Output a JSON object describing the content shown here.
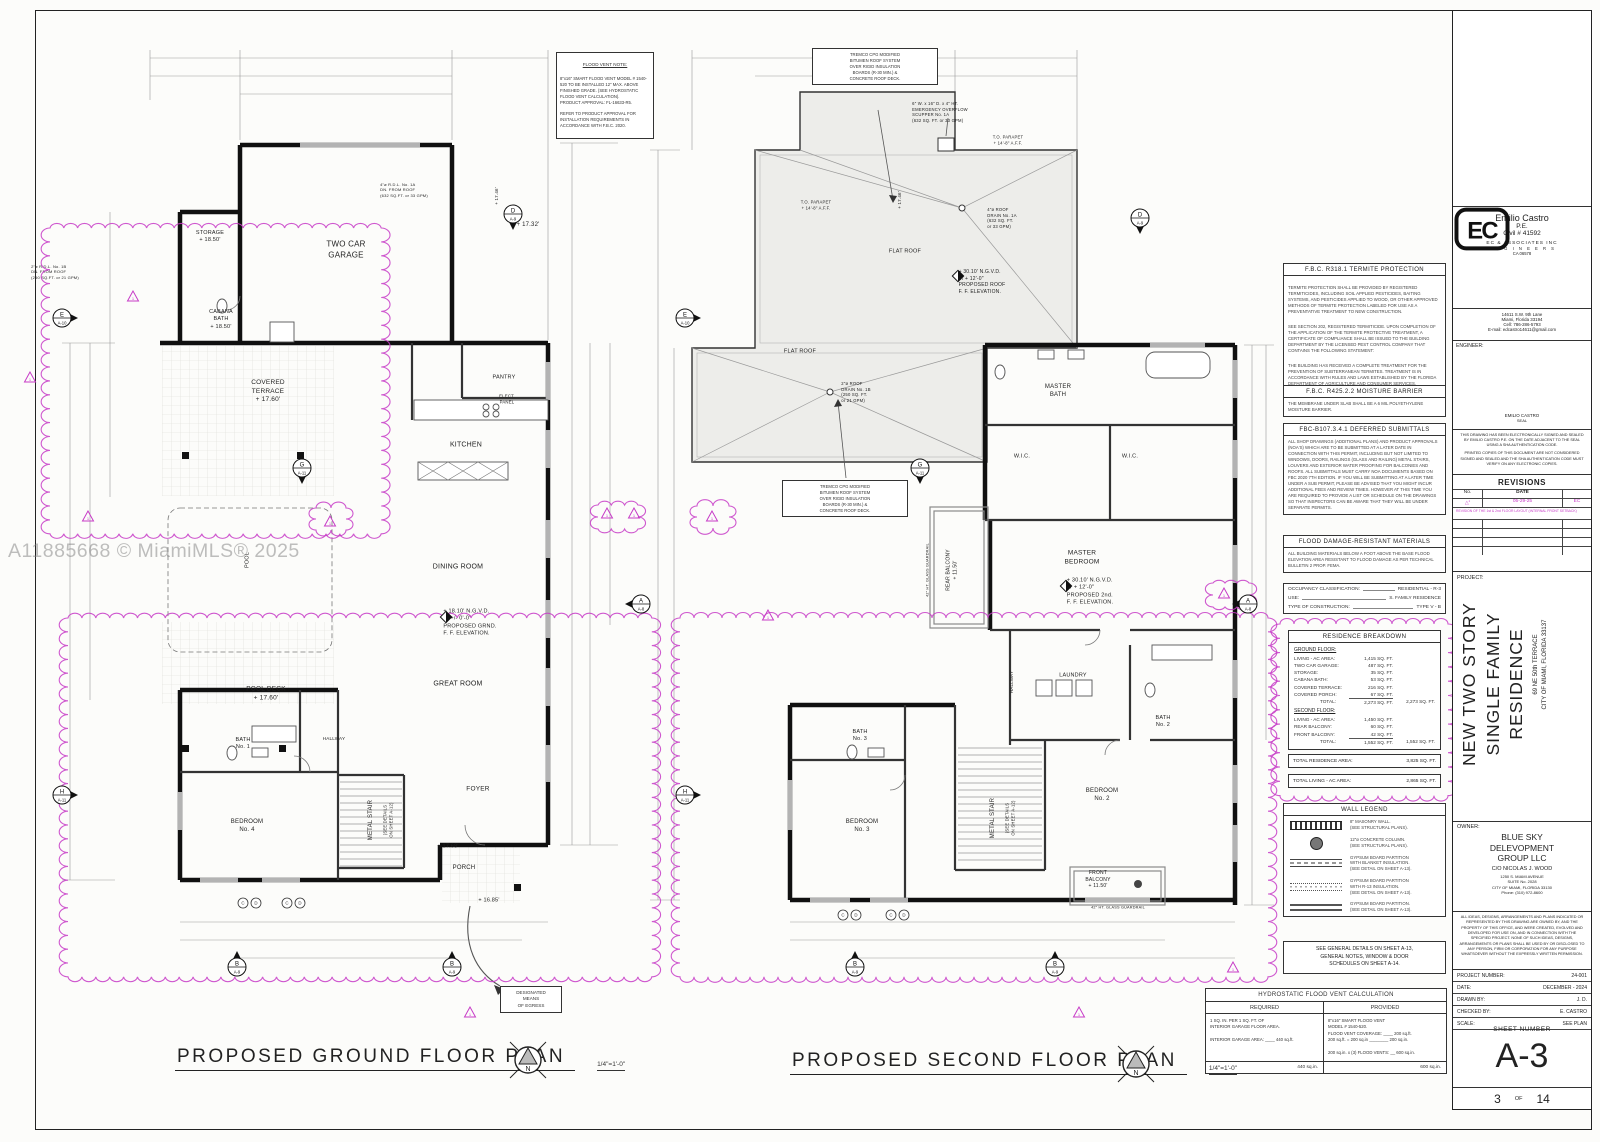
{
  "sheet": {
    "watermark": "A11885668 © MiamiMLS® 2025"
  },
  "plans": {
    "ground": {
      "title": "PROPOSED GROUND FLOOR PLAN",
      "scale": "1/4\"=1'-0\"",
      "flood_vent_note": {
        "title": "FLOOD VENT NOTE:",
        "body": "8\"x16\" SMART FLOOD VENT MODEL # 1540-520 TO BE INSTALLED 12\" MAX. ABOVE FINISHED GRADE. (SEE HYDROSTATIC FLOOD VENT CALCULATION).\nPRODUCT APPROVAL: FL-16633-R5.\n\nREFER TO PRODUCT APPROVAL FOR INSTALLATION REQUIREMENTS IN ACCORDANCE WITH F.B.C. 2020."
      },
      "egress_note": "DESIGNATED\nMEANS\nOF EGRESS"
    },
    "second": {
      "title": "PROPOSED SECOND FLOOR PLAN",
      "scale": "1/4\"=1'-0\"",
      "tremco_note": "TREMCO CPG MODIFIED\nBITUMEN ROOF SYSTEM\nOVER RIGID INSULATION\nBOARDS (R-30 MIN.) &\nCONCRETE ROOF DECK."
    }
  },
  "plan_labels": [
    {
      "n": "storage-label",
      "t": "STORAGE\n+ 18.50'",
      "x": 210,
      "y": 237,
      "fs": 5.5
    },
    {
      "n": "cabana-bath-label",
      "t": "CABANA\nBATH\n+ 18.50'",
      "x": 221,
      "y": 320,
      "fs": 5.5
    },
    {
      "n": "two-car-garage-label",
      "t": "TWO CAR\nGARAGE",
      "x": 346,
      "y": 250,
      "fs": 8
    },
    {
      "n": "elev-1732-label",
      "t": "+ 17.32'",
      "x": 528,
      "y": 226,
      "fs": 6
    },
    {
      "n": "elev-1746-ground-label",
      "t": "+ 17.46'",
      "x": 497,
      "y": 196,
      "fs": 4.5,
      "rot": -90
    },
    {
      "n": "covered-terrace-label",
      "t": "COVERED\nTERRACE\n+ 17.60'",
      "x": 268,
      "y": 392,
      "fs": 6.5
    },
    {
      "n": "pantry-label",
      "t": "PANTRY",
      "x": 504,
      "y": 378,
      "fs": 5.5
    },
    {
      "n": "elect-panel-label",
      "t": "ELECT.\nPANEL",
      "x": 507,
      "y": 399,
      "fs": 4.3
    },
    {
      "n": "kitchen-label",
      "t": "KITCHEN",
      "x": 466,
      "y": 445,
      "fs": 7
    },
    {
      "n": "dining-room-label",
      "t": "DINING ROOM",
      "x": 458,
      "y": 567,
      "fs": 7
    },
    {
      "n": "ground-ff-elevation",
      "t": "+ 18.10' N.G.V.D.\nor +/- 0'-0\"\nPROPOSED GRND.\nF. F. ELEVATION.",
      "x": 470,
      "y": 623,
      "fs": 5.5,
      "al": "left"
    },
    {
      "n": "great-room-label",
      "t": "GREAT ROOM",
      "x": 458,
      "y": 684,
      "fs": 7
    },
    {
      "n": "pool-deck-label",
      "t": "POOL DECK\n+ 17.60'",
      "x": 266,
      "y": 694,
      "fs": 6.5
    },
    {
      "n": "pool-label",
      "t": "POOL",
      "x": 248,
      "y": 560,
      "fs": 5.5,
      "rot": -90
    },
    {
      "n": "bath-1-label",
      "t": "BATH\nNo. 1",
      "x": 243,
      "y": 744,
      "fs": 5.5
    },
    {
      "n": "hallway-ground-label",
      "t": "HALLWAY",
      "x": 334,
      "y": 739,
      "fs": 4.6
    },
    {
      "n": "bedroom-4-label",
      "t": "BEDROOM\nNo. 4",
      "x": 247,
      "y": 827,
      "fs": 6
    },
    {
      "n": "metal-stair-ground-label",
      "t": "METAL STAIR",
      "x": 372,
      "y": 820,
      "fs": 6,
      "rot": -90
    },
    {
      "n": "metal-stair-ground-note",
      "t": "(SEE DETAILS\nON SHEET A-12)",
      "x": 388,
      "y": 820,
      "fs": 4.2,
      "rot": -90
    },
    {
      "n": "foyer-label",
      "t": "FOYER",
      "x": 478,
      "y": 790,
      "fs": 6.5
    },
    {
      "n": "porch-label",
      "t": "PORCH",
      "x": 464,
      "y": 869,
      "fs": 6
    },
    {
      "n": "elev-1768-label",
      "t": "+ 17.68'",
      "x": 448,
      "y": 847,
      "fs": 5.5
    },
    {
      "n": "elev-1685-label",
      "t": "+ 16.85'",
      "x": 489,
      "y": 901,
      "fs": 5.5
    },
    {
      "n": "rdl-1a-note",
      "t": "4\"ø R.D.L. No. 1A\nDN. FROM ROOF\n(632 SQ.FT. or 33 GPM)",
      "x": 404,
      "y": 190,
      "fs": 4,
      "al": "left"
    },
    {
      "n": "rdl-1b-note",
      "t": "2\"ø R.D.L. No. 1B\nDN. FROM ROOF\n(250 SQ.FT. or 21 GPM)",
      "x": 55,
      "y": 272,
      "fs": 4,
      "al": "left"
    },
    {
      "n": "scupper-note",
      "t": "6\" W. x 16\" D. x 4\" HT.\nEMERGENCY OVERFLOW\nSCUPPER No. 1A\n(632 SQ. FT. or 33 GPM)",
      "x": 940,
      "y": 112,
      "fs": 4.2,
      "al": "left"
    },
    {
      "n": "parapet-note-1",
      "t": "T.O. PARAPET\n+ 14'-8\" A.F.F.",
      "x": 1008,
      "y": 140,
      "fs": 4.2
    },
    {
      "n": "parapet-note-2",
      "t": "T.O. PARAPET\n+ 14'-8\" A.F.F.",
      "x": 816,
      "y": 205,
      "fs": 4.2
    },
    {
      "n": "elev-1746-second-label",
      "t": "+ 17.46'",
      "x": 900,
      "y": 200,
      "fs": 4.5,
      "rot": -90
    },
    {
      "n": "roof-drain-1a-note",
      "t": "4\"ø ROOF\nDRAIN No. 1A\n(632 SQ. FT.\nor 33 GPM)",
      "x": 1002,
      "y": 218,
      "fs": 4.2,
      "al": "left"
    },
    {
      "n": "roof-ff-elevation",
      "t": "+ 30.10' N.G.V.D.\nor + 12'-0\"\nPROPOSED ROOF\nF. F. ELEVATION.",
      "x": 982,
      "y": 282,
      "fs": 5,
      "al": "left"
    },
    {
      "n": "flat-roof-label-1",
      "t": "FLAT ROOF",
      "x": 905,
      "y": 252,
      "fs": 5.5
    },
    {
      "n": "flat-roof-label-2",
      "t": "FLAT ROOF",
      "x": 800,
      "y": 352,
      "fs": 5.5
    },
    {
      "n": "roof-drain-1b-note",
      "t": "2\"ø ROOF\nDRAIN No. 1B\n(250 SQ. FT.\nor 21 GPM)",
      "x": 856,
      "y": 392,
      "fs": 4.2,
      "al": "left"
    },
    {
      "n": "master-bath-label",
      "t": "MASTER\nBATH",
      "x": 1058,
      "y": 392,
      "fs": 6
    },
    {
      "n": "wic-left-label",
      "t": "W.I.C.",
      "x": 1022,
      "y": 457,
      "fs": 5.5
    },
    {
      "n": "wic-right-label",
      "t": "W.I.C.",
      "x": 1130,
      "y": 457,
      "fs": 5.5
    },
    {
      "n": "master-bedroom-label",
      "t": "MASTER\nBEDROOM",
      "x": 1082,
      "y": 558,
      "fs": 6.5
    },
    {
      "n": "second-ff-elevation",
      "t": "+ 30.10' N.G.V.D.\nor + 12'-0\"\nPROPOSED 2nd.\nF. F. ELEVATION.",
      "x": 1090,
      "y": 592,
      "fs": 5.5,
      "al": "left"
    },
    {
      "n": "rear-balcony-label",
      "t": "REAR BALCONY\n+ 11.50'",
      "x": 952,
      "y": 570,
      "fs": 5,
      "rot": -90
    },
    {
      "n": "rear-guardrail-note",
      "t": "42\" HT. GLASS GUARDRAIL",
      "x": 928,
      "y": 570,
      "fs": 3.8,
      "rot": -90
    },
    {
      "n": "laundry-label",
      "t": "LAUNDRY",
      "x": 1073,
      "y": 676,
      "fs": 5.5
    },
    {
      "n": "bath-2-label",
      "t": "BATH\nNo. 2",
      "x": 1163,
      "y": 722,
      "fs": 5.5
    },
    {
      "n": "hallway-second-label",
      "t": "HALLWAY",
      "x": 1012,
      "y": 682,
      "fs": 4.6,
      "rot": -90
    },
    {
      "n": "bedroom-2-label",
      "t": "BEDROOM\nNo. 2",
      "x": 1102,
      "y": 796,
      "fs": 6
    },
    {
      "n": "front-balcony-label",
      "t": "FRONT\nBALCONY\n+ 11.50'",
      "x": 1098,
      "y": 880,
      "fs": 5
    },
    {
      "n": "front-guardrail-note",
      "t": "42\" HT. GLASS GUARDRAIL",
      "x": 1118,
      "y": 908,
      "fs": 3.8
    },
    {
      "n": "bedroom-3-label",
      "t": "BEDROOM\nNo. 3",
      "x": 862,
      "y": 827,
      "fs": 6
    },
    {
      "n": "bath-3-label",
      "t": "BATH\nNo. 3",
      "x": 860,
      "y": 736,
      "fs": 5.5
    },
    {
      "n": "metal-stair-second-label",
      "t": "METAL STAIR",
      "x": 994,
      "y": 818,
      "fs": 6,
      "rot": -90
    },
    {
      "n": "metal-stair-second-note",
      "t": "(SEE DETAILS\nON SHEET A-12)",
      "x": 1010,
      "y": 818,
      "fs": 4.2,
      "rot": -90
    }
  ],
  "annotations": {
    "clouds": [
      {
        "x": 50,
        "y": 228,
        "w": 330,
        "h": 305
      },
      {
        "x": 68,
        "y": 618,
        "w": 585,
        "h": 360
      },
      {
        "x": 680,
        "y": 618,
        "w": 588,
        "h": 360
      },
      {
        "x": 1280,
        "y": 624,
        "w": 168,
        "h": 172
      },
      {
        "x": 598,
        "y": 505,
        "w": 40,
        "h": 24
      },
      {
        "x": 1213,
        "y": 583,
        "w": 36,
        "h": 24
      },
      {
        "x": 697,
        "y": 506,
        "w": 32,
        "h": 22
      },
      {
        "x": 316,
        "y": 508,
        "w": 30,
        "h": 22
      }
    ],
    "rev_triangles": [
      {
        "x": 133,
        "y": 297
      },
      {
        "x": 30,
        "y": 378
      },
      {
        "x": 330,
        "y": 522
      },
      {
        "x": 607,
        "y": 514
      },
      {
        "x": 634,
        "y": 514
      },
      {
        "x": 768,
        "y": 616
      },
      {
        "x": 1224,
        "y": 594
      },
      {
        "x": 1233,
        "y": 968
      },
      {
        "x": 470,
        "y": 1013
      },
      {
        "x": 1079,
        "y": 1013
      },
      {
        "x": 88,
        "y": 517
      },
      {
        "x": 712,
        "y": 517
      }
    ],
    "markers": [
      {
        "l": "D",
        "s": "A-9",
        "x": 513,
        "y": 214,
        "dir": 90
      },
      {
        "l": "E",
        "s": "A-10",
        "x": 62,
        "y": 318,
        "dir": 0
      },
      {
        "l": "G",
        "s": "A-11",
        "x": 302,
        "y": 468,
        "dir": 90
      },
      {
        "l": "H",
        "s": "A-11",
        "x": 62,
        "y": 795,
        "dir": 0
      },
      {
        "l": "A",
        "s": "A-8",
        "x": 641,
        "y": 604,
        "dir": 180
      },
      {
        "l": "B",
        "s": "A-9",
        "x": 237,
        "y": 967,
        "dir": -90
      },
      {
        "l": "B",
        "s": "A-9",
        "x": 452,
        "y": 967,
        "dir": -90
      },
      {
        "l": "D",
        "s": "A-9",
        "x": 1140,
        "y": 218,
        "dir": 90
      },
      {
        "l": "E",
        "s": "A-10",
        "x": 685,
        "y": 318,
        "dir": 0
      },
      {
        "l": "G",
        "s": "A-11",
        "x": 920,
        "y": 468,
        "dir": 90
      },
      {
        "l": "H",
        "s": "A-11",
        "x": 685,
        "y": 795,
        "dir": 0
      },
      {
        "l": "A",
        "s": "A-8",
        "x": 1248,
        "y": 604,
        "dir": 180
      },
      {
        "l": "B",
        "s": "A-9",
        "x": 855,
        "y": 967,
        "dir": -90
      },
      {
        "l": "B",
        "s": "A-9",
        "x": 1055,
        "y": 967,
        "dir": -90
      }
    ],
    "window_tags": [
      {
        "x": 243,
        "y": 903,
        "l": "C"
      },
      {
        "x": 256,
        "y": 903,
        "l": "D"
      },
      {
        "x": 287,
        "y": 903,
        "l": "C"
      },
      {
        "x": 300,
        "y": 903,
        "l": "D"
      },
      {
        "x": 843,
        "y": 915,
        "l": "C"
      },
      {
        "x": 856,
        "y": 915,
        "l": "D"
      },
      {
        "x": 891,
        "y": 915,
        "l": "C"
      },
      {
        "x": 904,
        "y": 915,
        "l": "D"
      }
    ],
    "elev_markers": [
      {
        "x": 446,
        "y": 617
      },
      {
        "x": 958,
        "y": 276
      },
      {
        "x": 1066,
        "y": 586
      }
    ]
  },
  "notes": {
    "termite": {
      "title": "F.B.C. R318.1    TERMITE PROTECTION",
      "p1": "TERMITE PROTECTION SHALL BE PROVIDED BY REGISTERED TERMITICIDES, INCLUDING SOIL APPLIED PESTICIDES, BAITING SYSTEMS, AND PESTICIDES APPLIED TO WOOD, OR OTHER APPROVED METHODS OF TERMITE PROTECTION LABELED FOR USE AS A PREVENTATIVE TREATMENT TO NEW CONSTRUCTION.",
      "p2": "SEE SECTION 202, REGISTERED TERMITICIDE. UPON COMPLETION OF THE APPLICATION OF THE TERMITE PROTECTIVE TREATMENT, A CERTIFICATE OF COMPLIANCE SHALL BE ISSUED TO THE BUILDING DEPARTMENT BY THE LICENSED PEST CONTROL COMPANY THAT CONTAINS THE FOLLOWING STATEMENT:",
      "p3": "THE BUILDING HAS RECEIVED A COMPLETE TREATMENT FOR THE PREVENTION OF SUBTERRANEAN TERMITES. TREATMENT IS IN ACCORDANCE WITH RULES AND LAWS ESTABLISHED BY THE FLORIDA DEPARTMENT OF AGRICULTURE AND CONSUMER SERVICES."
    },
    "moisture": {
      "title": "F.B.C. R425.2.2   MOISTURE BARRIER",
      "body": "THE MEMBRANE UNDER SLAB SHALL BE A 6 MIL POLYETHYLENE MOISTURE BARRIER."
    },
    "deferred": {
      "title": "FBC-B107.3.4.1   DEFERRED SUBMITTALS",
      "body": "ALL SHOP DRAWINGS (ADDITIONAL PLANS) AND PRODUCT APPROVALS (NOA'S) WHICH ARE TO BE SUBMITTED AT A LATER DATE IN CONNECTION WITH THIS PERMIT, INCLUDING BUT NOT LIMITED TO WINDOWS, DOORS, RAILINGS (GLASS AND RAILING) METAL STAIRS, LOUVERS AND EXTERIOR WATER PROOFING FOR BALCONIES AND ROOFS. ALL SUBMITTALS MUST CARRY NOA DOCUMENTS BASED ON FBC 2020 7TH EDITION. IF YOU WILL BE SUBMITTING AT A LATER TIME UNDER A SUB PERMIT, PLEASE BE ADVISED THAT YOU MIGHT INCUR ADDITIONAL FEES AND REVIEW TIMES. HOWEVER AT THIS TIME YOU ARE REQUIRED TO PROVIDE A LIST OR SCHEDULE ON THE DRAWINGS SO THAT INSPECTORS CAN BE AWARE THAT THEY WILL BE UNDER SEPARATE PERMITS."
    },
    "flood_materials": {
      "title": "FLOOD DAMAGE-RESISTANT MATERIALS",
      "body": "ALL BUILDING MATERIALS BELOW A FOOT ABOVE THE BASE FLOOD ELEVATION AREA RESISTANT TO FLOOD DAMAGE AS PER TECHNICAL BULLETIN 2 PROP. FEMA."
    },
    "occupancy": {
      "rows": [
        {
          "label": "OCCUPANCY CLASSIFICATION:",
          "value": "RESIDENTIAL - R-3"
        },
        {
          "label": "USE:",
          "value": "S. FAMILY RESIDENCE"
        },
        {
          "label": "TYPE OF CONSTRUCTION:",
          "value": "TYPE V - B"
        }
      ]
    },
    "see_general": "SEE GENERAL DETAILS ON SHEET A-13,\nGENERAL NOTES, WINDOW & DOOR\nSCHEDULES ON SHEET A-14."
  },
  "breakdown": {
    "title": "RESIDENCE BREAKDOWN",
    "ground_heading": "GROUND FLOOR:",
    "ground_rows": [
      {
        "label": "LIVING - AC AREA:",
        "value": "1,415 SQ. FT."
      },
      {
        "label": "TWO CAR GARAGE:",
        "value": "487 SQ. FT."
      },
      {
        "label": "STORAGE:",
        "value": "35 SQ. FT."
      },
      {
        "label": "CABANA BATH:",
        "value": "53 SQ. FT."
      },
      {
        "label": "COVERED TERRACE:",
        "value": "216 SQ. FT."
      },
      {
        "label": "COVERED PORCH:",
        "value": "67 SQ. FT."
      }
    ],
    "ground_total": {
      "label": "TOTAL:",
      "value": "2,273 SQ. FT.",
      "value2": "2,273 SQ. FT."
    },
    "second_heading": "SECOND FLOOR:",
    "second_rows": [
      {
        "label": "LIVING - AC AREA:",
        "value": "1,450 SQ. FT."
      },
      {
        "label": "REAR BALCONY:",
        "value": "60 SQ. FT."
      },
      {
        "label": "FRONT BALCONY:",
        "value": "42 SQ. FT."
      }
    ],
    "second_total": {
      "label": "TOTAL:",
      "value": "1,552 SQ. FT.",
      "value2": "1,552 SQ. FT."
    },
    "residence_total": {
      "label": "TOTAL RESIDENCE AREA:",
      "value": "3,825 SQ. FT."
    },
    "living_total": {
      "label": "TOTAL LIVING - AC AREA:",
      "value": "2,865 SQ. FT."
    }
  },
  "legend": {
    "title": "WALL LEGEND",
    "items": [
      {
        "sym": "masonry",
        "text": "8\" MASONRY WALL.\n(SEE STRUCTURAL PLANS)."
      },
      {
        "sym": "column",
        "text": "12\"ø CONCRETE COLUMN.\n(SEE STRUCTURAL PLANS)."
      },
      {
        "sym": "gyp-blanket",
        "text": "GYPSUM BOARD PARTITION\nWITH BLANKET INSULATION.\n(SEE DETAIL ON SHEET A-13)."
      },
      {
        "sym": "gyp-r13",
        "text": "GYPSUM BOARD PARTITION\nWITH R-13 INSULATION.\n(SEE DETAIL ON SHEET A-13)."
      },
      {
        "sym": "gyp",
        "text": "GYPSUM BOARD PARTITION.\n(SEE DETAIL ON SHEET A-13)."
      }
    ]
  },
  "hydro": {
    "title": "HYDROSTATIC FLOOD VENT CALCULATION",
    "col_required": "REQUIRED",
    "col_provided": "PROVIDED",
    "required_text": "1 SQ. IN. PER 1 SQ. FT. OF\nINTERIOR GARAGE FLOOR AREA.\n\nINTERIOR GARAGE AREA: ____ 440 sq.ft.",
    "provided_text": "8\"x16\" SMART FLOOD VENT\nMODEL # 1540-520.\nFLOOD VENT COVERAGE: ____ 200 sq.ft.\n200 sq.ft. = 200 sq.in ________ 200 sq.in.\n\n200 sq.in. x (3) FLOOD VENTS: __ 600 sq.in.",
    "required_total": "440 sq.in.",
    "provided_total": "600 sq.in."
  },
  "titleblock": {
    "logo_text": "EC",
    "engineer": {
      "name": "Emilio Castro",
      "title": "P.E.",
      "license": "Civil # 41592",
      "firm": "EC & ASSOCIATES INC",
      "firm2": "E N G I N E E R S",
      "firm_ca": "CA 06578",
      "addr1": "14611 S.W. 9th Lane",
      "addr2": "Miami, Florida 33194",
      "addr3": "Cell: 786-286-5793",
      "addr4": "E-mail: edcastro14611@gmail.com"
    },
    "engineer_label": "ENGINEER:",
    "seal_name": "EMILIO CASTRO",
    "seal_word": "SEAL",
    "esign1": "THIS DRAWING HAS BEEN ELECTRONICALLY SIGNED AND SEALED BY EMILIO CASTRO P.E. ON THE DATE ADJACENT TO THE SEAL USING A SHA AUTHENTICATION CODE.",
    "esign2": "PRINTED COPIES OF THIS DOCUMENT ARE NOT CONSIDERED SIGNED AND SEALED AND THE SHA AUTHENTICATION CODE MUST VERIFY ON ANY ELECTRONIC COPIES.",
    "revisions": {
      "title": "REVISIONS",
      "col_no": "No.",
      "col_date": "DATE",
      "row": {
        "no": "1",
        "date": "05-29-25",
        "by": "EC"
      },
      "note": "REVISION OF THE 1st & 2nd FLOOR LAYOUT (INTERNAL FRONT SETBACK)"
    },
    "project_label": "PROJECT:",
    "project_line1": "NEW TWO STORY",
    "project_line2": "SINGLE FAMILY RESIDENCE",
    "project_addr1": "69 NE 50th TERRACE",
    "project_addr2": "CITY OF MIAMI, FLORIDA 33137",
    "owner_label": "OWNER:",
    "owner_name": "BLUE SKY\nDELEVOPMENT\nGROUP LLC",
    "owner_co": "C/O NICOLAS J. WOOD",
    "owner_addr": "1250 S. MIAMI AVENUE\nSUITE No. 2028\nCITY OF MIAMI, FLORIDA 33130\nPhone: (310) 972-8600",
    "legal": "ALL IDEAS, DESIGNS, ARRANGEMENTS AND PLANS INDICATED OR REPRESENTED BY THIS DRAWING ARE OWNED BY, AND THE PROPERTY OF THIS OFFICE, AND WERE CREATED, EVOLVED AND DEVELOPED FOR USE ON, AND IN CONNECTION WITH THE SPECIFIED PROJECT. NONE OF SUCH IDEAS, DESIGNS, ARRANGEMENTS OR PLANS SHALL BE USED BY OR DISCLOSED TO ANY PERSON, FIRM OR CORPORATION FOR ANY PURPOSE WHATSOEVER WITHOUT THE EXPRESSLY WRITTEN PERMISSION.",
    "info_rows": [
      {
        "label": "PROJECT NUMBER:",
        "value": "24-001"
      },
      {
        "label": "DATE:",
        "value": "DECEMBER - 2024"
      },
      {
        "label": "DRAWN BY:",
        "value": "J. D."
      },
      {
        "label": "CHECKED BY:",
        "value": "E. CASTRO"
      },
      {
        "label": "SCALE:",
        "value": "SEE PLAN"
      }
    ],
    "sheet_label": "SHEET NUMBER",
    "sheet_number": "A-3",
    "page_no": "3",
    "page_of": "OF",
    "page_total": "14"
  }
}
